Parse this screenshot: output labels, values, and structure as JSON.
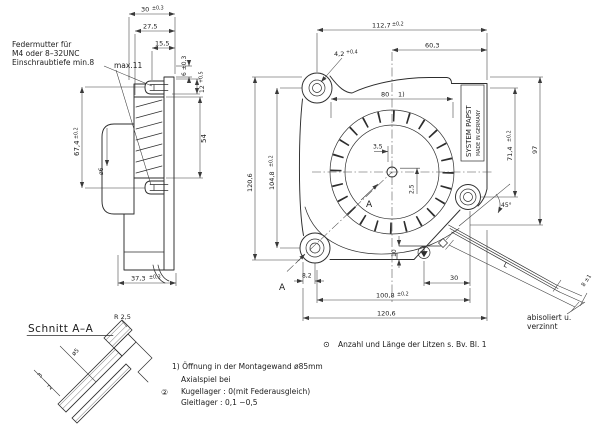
{
  "side": {
    "note1": "Federmutter für",
    "note2": "M4 oder 8–32UNC",
    "note3": "Einschraubtiefe min.8",
    "max11": "max.11",
    "d30": "30",
    "t30": "±0,3",
    "d27_5": "27,5",
    "d15_5": "15,5",
    "d6": "6 ±0,3",
    "d12": "12",
    "t12": "+0,5",
    "d54": "54",
    "d67_4": "67,4",
    "t67_4": "±0,2",
    "dia6": "ø6",
    "d37_3": "37,3",
    "t37_3": "±0,3"
  },
  "front": {
    "d112_7": "112,7",
    "t112_7": "±0,2",
    "d4_2": "4,2",
    "t4_2": "+0,4",
    "d60_3": "60,3",
    "d80": "80",
    "ref80": "1)",
    "d3_5": "3,5",
    "d2_5": "2,5",
    "d71_4": "71,4",
    "t71_4": "±0,2",
    "d97": "97",
    "d120_6_left": "120,6",
    "d104_8": "104,8",
    "t104_8": "±0,2",
    "d8_2": "8,2",
    "d10": "10",
    "d30": "30",
    "d100_8": "100,8",
    "t100_8": "±0,2",
    "d120_6_bottom": "120,6",
    "angle": "45°",
    "wire_len": "L",
    "wire_tip": "8 ±1",
    "wire_note1": "abisoliert u.",
    "wire_note2": "verzinnt",
    "brand1": "SYSTEM PAPST",
    "brand2": "MADE IN GERMANY",
    "section_a": "A"
  },
  "section": {
    "title": "Schnitt A–A",
    "r": "R 2,5",
    "dia5": "ø5",
    "d3": "3",
    "d2": "2"
  },
  "notes": {
    "litzen_sym": "⊙",
    "litzen": "Anzahl und Länge der Litzen s. Bv. Bl. 1",
    "fn1": "1) Öffnung in der Montagewand ø85mm",
    "axial0": "Axialspiel bei",
    "axial_sym": "②",
    "axial1": "Kugellager : 0(mit Federausgleich)",
    "axial2": "Gleitlager : 0,1 −0,5"
  }
}
